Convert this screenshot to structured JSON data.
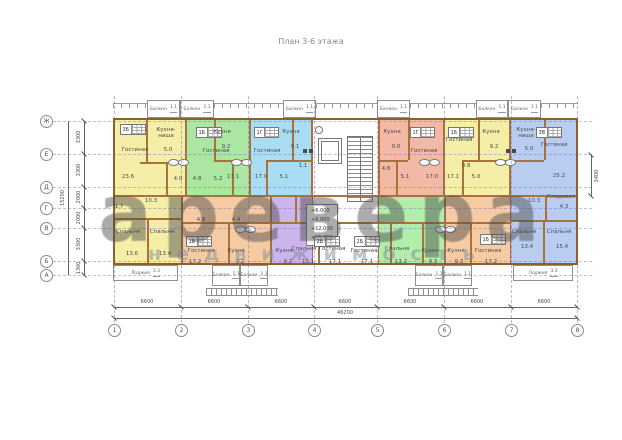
{
  "title": "План 3-6 этажа",
  "watermark": {
    "main": "аревера",
    "sub": "недвижимость"
  },
  "axes": {
    "rows": [
      "Ж",
      "Е",
      "Д",
      "Г",
      "В",
      "Б",
      "А"
    ],
    "cols": [
      "1",
      "2",
      "3",
      "4",
      "5",
      "6",
      "7",
      "8"
    ]
  },
  "dims": {
    "bottom": [
      "6600",
      "6600",
      "6600",
      "6600",
      "6600",
      "6600",
      "6600"
    ],
    "bottom_total": "46200",
    "left": [
      "3300",
      "3300",
      "2000",
      "2000",
      "3300",
      "1300"
    ],
    "left_total": "15200",
    "right": "3400"
  },
  "core": {
    "elevations": [
      "+6.000",
      "+9.000",
      "+12.000",
      "+15.000"
    ]
  },
  "labels": {
    "balcony": "Балкон",
    "loggia": "Лоджия",
    "balcony_area": "1.1",
    "loggia_area": "3.3"
  },
  "colors": {
    "wall": "#a9713c",
    "axis": "#9a9ad0",
    "yellow": "#f4eea6",
    "green": "#abe7a3",
    "blue": "#a9ddf3",
    "salmon": "#f3b9a6",
    "periwinkle": "#b9cdf1",
    "orange": "#f6cba4",
    "purple": "#ccb5eb",
    "green2": "#b2eda9"
  },
  "apts": [
    {
      "id": "3Б",
      "living": "Гостиная",
      "living_a": "23.6",
      "kitchen": "Кухня-ниша",
      "kitchen_a": "5.0",
      "hall_a": "4.0",
      "corr_a": "10.3",
      "wc_a": "1.7",
      "bed1": "Спальня",
      "bed1_a": "13.6",
      "bed2": "Спальня",
      "bed2_a": "13.4"
    },
    {
      "id": "1Б",
      "kitchen": "Кухня",
      "kitchen_a": "9.2",
      "living": "Гостиная",
      "living_a": "17.1",
      "hall_a": "5.2",
      "bath_a": "4.8"
    },
    {
      "id": "1Г",
      "living": "Гостиная",
      "living_a": "17.0",
      "kitchen": "Кухня",
      "kitchen_a": "9.1",
      "hall_a": "5.1",
      "wc_a": "1.1"
    },
    {
      "id": "1Г",
      "kitchen": "Кухня",
      "kitchen_a": "9.0",
      "living": "Гостиная",
      "living_a": "17.0",
      "hall_a": "5.1",
      "bath_a": "4.8"
    },
    {
      "id": "1Б",
      "living": "Гостиная",
      "living_a": "17.1",
      "kitchen": "Кухня",
      "kitchen_a": "9.2",
      "hall_a": "5.0",
      "wc_a": "0.8"
    },
    {
      "id": "3В",
      "kitchen": "Кухня-ниша",
      "kitchen_a": "5.0",
      "living": "Гостиная",
      "living_a": "25.2",
      "storage": "Кладовая",
      "storage_a": "4.3",
      "corr_a": "10.3",
      "bed1": "Спальня",
      "bed1_a": "13.4",
      "bed2": "Спальня",
      "bed2_a": "15.4"
    },
    {
      "id": "1В",
      "living": "Гостиная",
      "living_a": "17.2",
      "kitchen": "Кухня",
      "kitchen_a": "9.2",
      "hall_a": "4.8",
      "bath_a": "4.4"
    },
    {
      "id": "2Б",
      "kitchen": "Кухня",
      "kitchen_a": "9.2",
      "bed1": "Спальня",
      "bed1_a": "13.1",
      "living": "Гостиная",
      "living_a": "17.1"
    },
    {
      "id": "2Б",
      "living": "Гостиная",
      "living_a": "17.1",
      "bed1": "Спальня",
      "bed1_a": "13.2",
      "kitchen": "Кухня",
      "kitchen_a": "9.3"
    },
    {
      "id": "1Б",
      "kitchen": "Кухня",
      "kitchen_a": "9.3",
      "living": "Гостиная",
      "living_a": "17.2"
    }
  ]
}
